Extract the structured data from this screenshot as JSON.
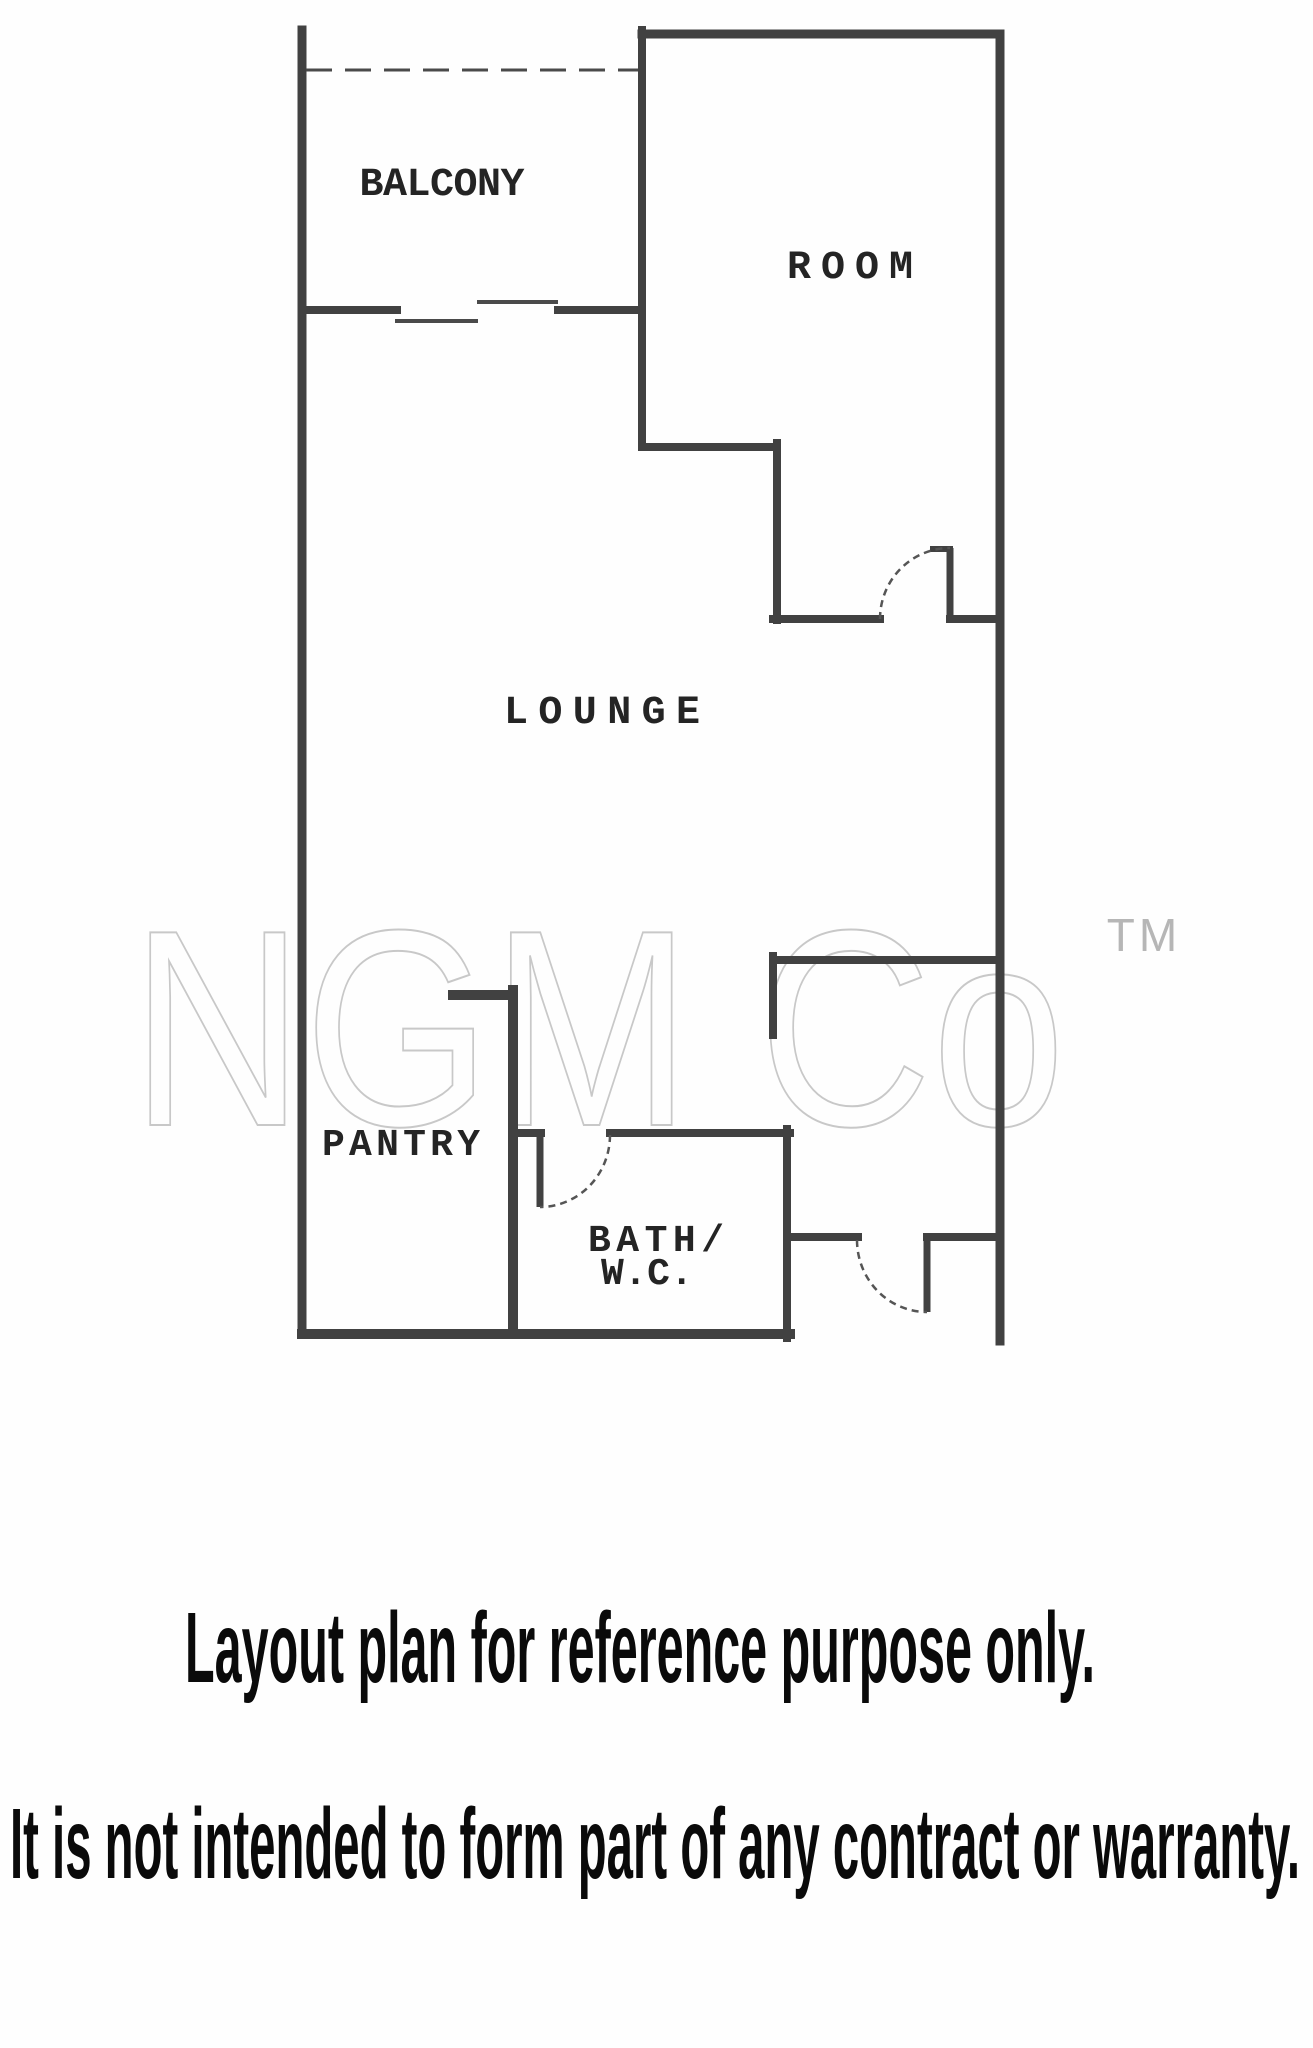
{
  "plan": {
    "rooms": {
      "balcony": "BALCONY",
      "room": "ROOM",
      "lounge": "LOUNGE",
      "pantry": "PANTRY",
      "bath_line1": "BATH/",
      "bath_line2": "W.C."
    },
    "watermark": {
      "text": "NGM Co",
      "tm": "TM"
    },
    "disclaimer": {
      "line1": "Layout plan for reference purpose only.",
      "line2": "It is not intended to form part of any contract or warranty."
    },
    "colors": {
      "background": "#fefefe",
      "wall": "#414141",
      "thin": "#4a4a4a",
      "arc": "#555555",
      "label": "#242424",
      "watermark": "#c8c8c8",
      "tm": "#b6b6b6",
      "disclaimer": "#0a0a0a"
    }
  }
}
